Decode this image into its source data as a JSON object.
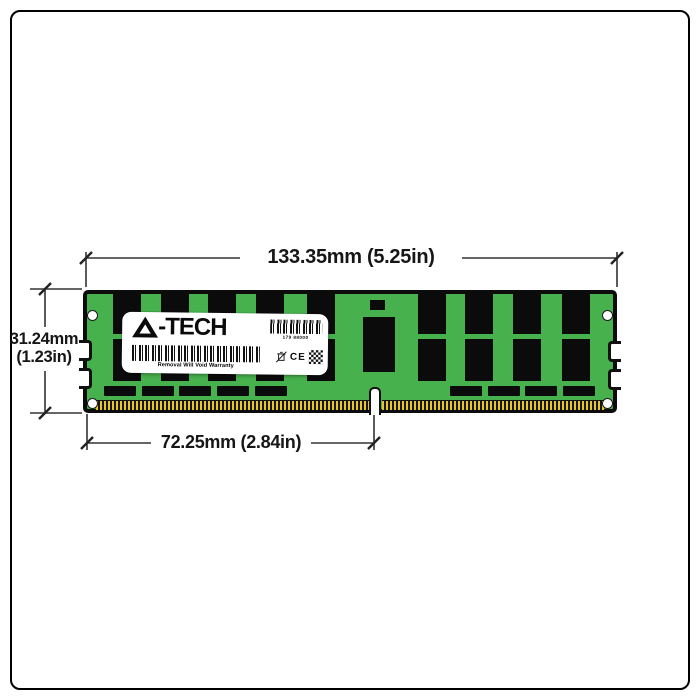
{
  "dimensions": {
    "top": "133.35mm (5.25in)",
    "left_mm": "31.24mm",
    "left_in": "(1.23in)",
    "bottom": "72.25mm (2.84in)"
  },
  "label": {
    "brand": "A-TECH",
    "brand_suffix": "-TECH",
    "serial_number": "179 88000",
    "warranty": "Removal Will Void Warranty",
    "ce_mark": "CE"
  },
  "module": {
    "description": "Green DDR4 LRDIMM memory module, front view",
    "chip_columns_left": 5,
    "chip_columns_right": 4,
    "bottom_chips_left": 5,
    "bottom_chips_right": 4,
    "has_center_register_chip": true,
    "mounting_holes": 4,
    "edge_notches_per_side": 2
  },
  "colors": {
    "pcb_green": "#47b14d",
    "chip_black": "#0b0b0b",
    "pin_gold": "#e7c52e",
    "line_dark": "#333333"
  }
}
